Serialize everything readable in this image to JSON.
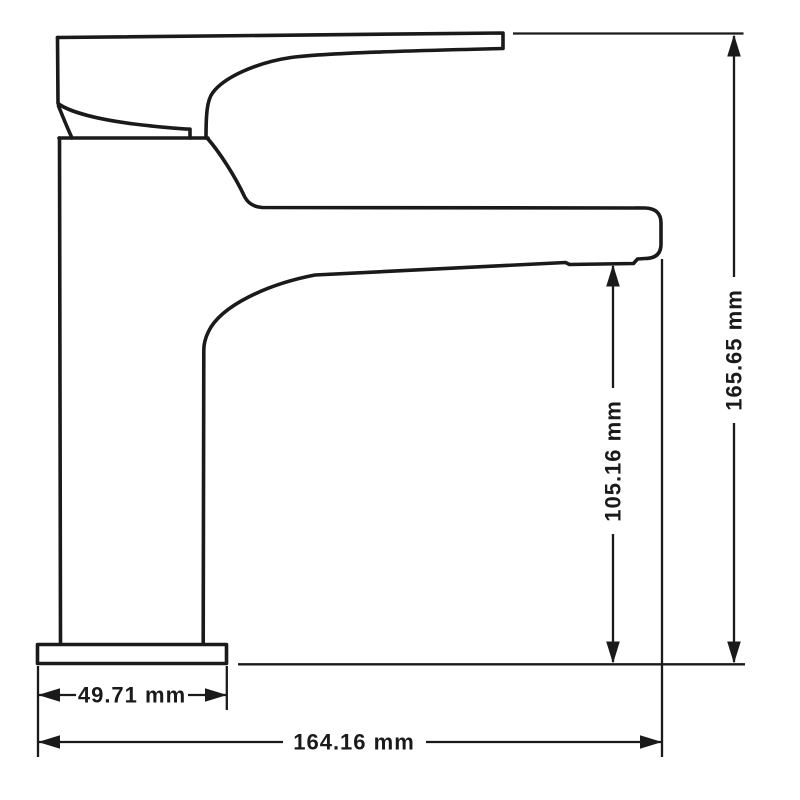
{
  "page": {
    "background": "#ffffff",
    "line_color": "#1a1a1a"
  },
  "drawing": {
    "kind": "technical-dimension-drawing",
    "subject": "single-lever-basin-mixer-tap-side-view",
    "unit": "mm",
    "dimensions": {
      "total_height": {
        "label": "165.65 mm",
        "value": 165.65,
        "unit": "mm",
        "orientation": "vertical"
      },
      "spout_height": {
        "label": "105.16 mm",
        "value": 105.16,
        "unit": "mm",
        "orientation": "vertical"
      },
      "base_width": {
        "label": "49.71 mm",
        "value": 49.71,
        "unit": "mm",
        "orientation": "horizontal"
      },
      "total_reach": {
        "label": "164.16 mm",
        "value": 164.16,
        "unit": "mm",
        "orientation": "horizontal"
      }
    }
  }
}
